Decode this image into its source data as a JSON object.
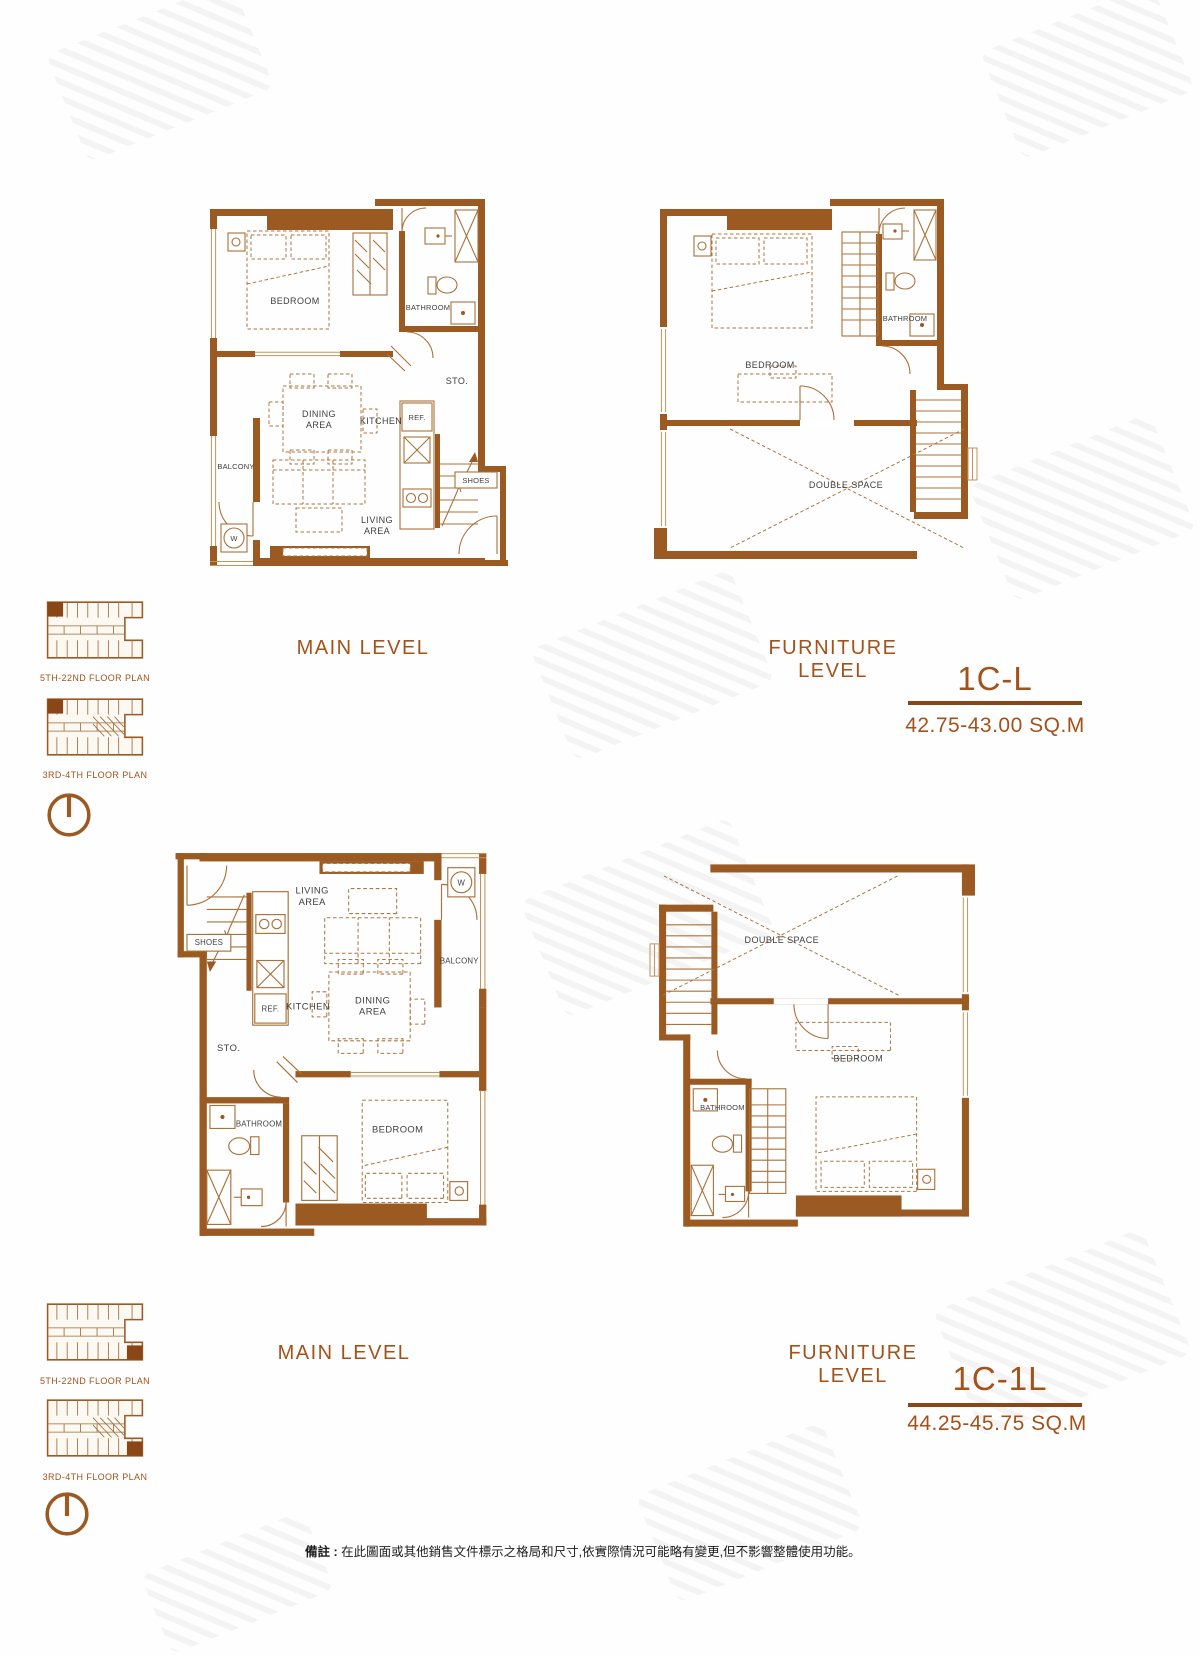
{
  "labels": {
    "main_level": "MAIN LEVEL",
    "furniture_level": "FURNITURE LEVEL"
  },
  "units": {
    "unit1": {
      "code": "1C-L",
      "area": "42.75-43.00 SQ.M"
    },
    "unit2": {
      "code": "1C-1L",
      "area": "44.25-45.75 SQ.M"
    }
  },
  "rooms": {
    "bedroom": "BEDROOM",
    "bathroom": "BATHROOM",
    "storage": "STO.",
    "dining1": "DINING",
    "dining2": "AREA",
    "kitchen": "KITCHEN",
    "fridge": "REF.",
    "balcony": "BALCONY",
    "living1": "LIVING",
    "living2": "AREA",
    "shoes": "SHOES",
    "washer": "W",
    "double_space": "DOUBLE SPACE"
  },
  "keyplan": {
    "upper": "5TH-22ND FLOOR PLAN",
    "lower": "3RD-4TH FLOOR PLAN"
  },
  "note": {
    "label": "備註 :",
    "text": "在此圖面或其他銷售文件標示之格局和尺寸,依實際情況可能略有變更,但不影響整體使用功能。"
  },
  "colors": {
    "wall": "#9a5a22",
    "accent": "#a3521a",
    "room_label": "#3f3f3f"
  }
}
